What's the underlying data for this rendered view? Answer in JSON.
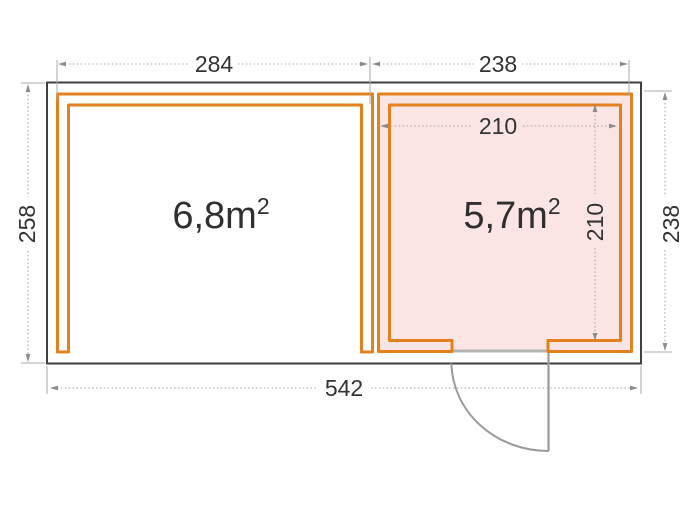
{
  "floor_plan": {
    "rooms": [
      {
        "id": "left-room",
        "label": "6,8m²",
        "area_text": "6,8m",
        "area_exponent": "2"
      },
      {
        "id": "right-room",
        "label": "5,7m²",
        "area_text": "5,7m",
        "area_exponent": "2"
      }
    ],
    "dimensions": {
      "top_left_width": "284",
      "top_right_width": "238",
      "left_height": "258",
      "right_height": "238",
      "total_width": "542",
      "room_inner_width": "210",
      "room_inner_height": "210"
    },
    "colors": {
      "wall_orange": "#E2811E",
      "room_fill_pink": "#FAE5E4",
      "outline_dark": "#3F3F3F",
      "dimension_gray": "#A6A6A6",
      "text_dark": "#333333",
      "door_gray": "#9A9A9A"
    }
  }
}
